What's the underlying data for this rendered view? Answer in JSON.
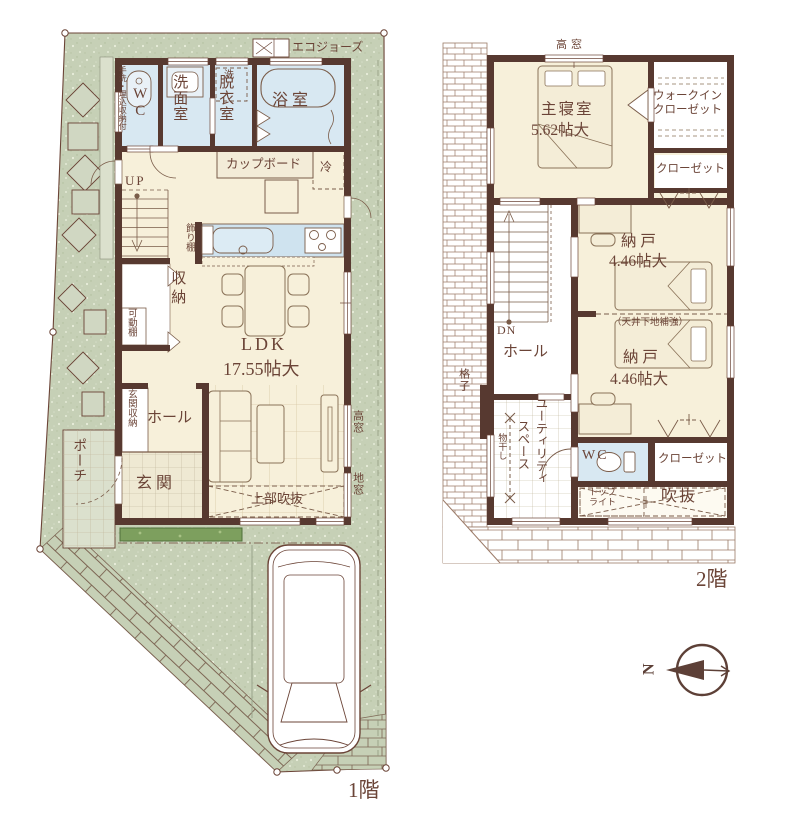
{
  "floor1": {
    "title": "1階",
    "eco": "エコジョーズ",
    "wc": "WC",
    "wc_note": "手洗・埋込収納付",
    "senmen": "洗面室",
    "sen": "洗",
    "datsui": "脱衣室",
    "bath": "浴 室",
    "cupboard": "カップボード",
    "fridge": "冷",
    "kazaridana": "飾り棚",
    "up": "UP",
    "shuno": "収納",
    "kadodana": "可動棚",
    "ldk": "LDK",
    "ldk_size": "17.55帖大",
    "genkan_shuno": "玄関収納",
    "hall": "ホール",
    "genkan": "玄 関",
    "porch": "ポーチ",
    "fukinuke": "上部吹抜",
    "takamado": "高窓",
    "jimado": "地窓"
  },
  "floor2": {
    "title": "2階",
    "takamado": "高窓",
    "master": "主寝室",
    "master_size": "5.62帖大",
    "wic1": "ウォークイン",
    "wic2": "クローゼット",
    "closet_upper": "クローゼット",
    "nando1": "納 戸",
    "nando1_size": "4.46帖大",
    "ceiling_note": "（天井下地補強）",
    "nando2": "納 戸",
    "nando2_size": "4.46帖大",
    "dn": "DN",
    "hall": "ホール",
    "koshi": "格子",
    "utility1": "ユーティリティ",
    "utility2": "スペース",
    "monohoshi": "物干し",
    "wc": "WC",
    "closet_lower": "クローゼット",
    "toplight1": "トップ",
    "toplight2": "ライト",
    "void": "吹抜"
  },
  "compass": {
    "north": "N"
  },
  "colors": {
    "wall": "#573930",
    "floor": "#f7f0da",
    "wet": "#d8e8f2",
    "garden": "#c6d0b6",
    "text": "#6b4437",
    "hedge": "#7d9f5e",
    "roof_line": "#9b7a67"
  }
}
